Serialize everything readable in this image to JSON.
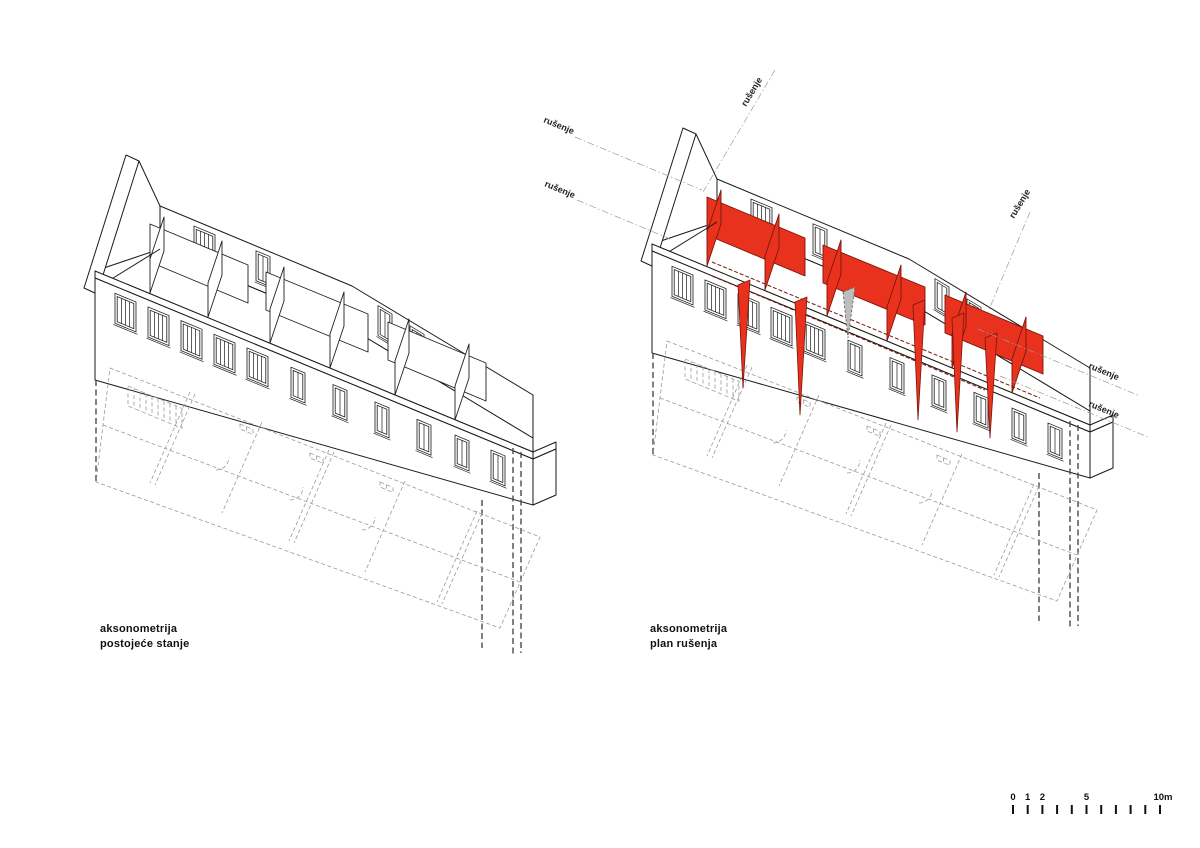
{
  "page": {
    "background": "#ffffff"
  },
  "colors": {
    "demolition_red": "#E8321E",
    "demolition_red_dark": "#7A150C",
    "line_black": "#1A1A1A",
    "ghost_gray": "#9A9A9A",
    "neutral_gray_wall": "#BDBDBD"
  },
  "left_diagram": {
    "caption": [
      "aksonometrija",
      "postojeće stanje"
    ]
  },
  "right_diagram": {
    "caption": [
      "aksonometrija",
      "plan rušenja"
    ],
    "annotations": [
      {
        "text": "rušenje"
      },
      {
        "text": "rušenje"
      },
      {
        "text": "rušenje"
      },
      {
        "text": "rušenje"
      },
      {
        "text": "rušenje"
      },
      {
        "text": "rušenje"
      }
    ]
  },
  "scale_bar": {
    "tick_labels": [
      "0",
      "1",
      "2",
      "5",
      "10m"
    ]
  }
}
